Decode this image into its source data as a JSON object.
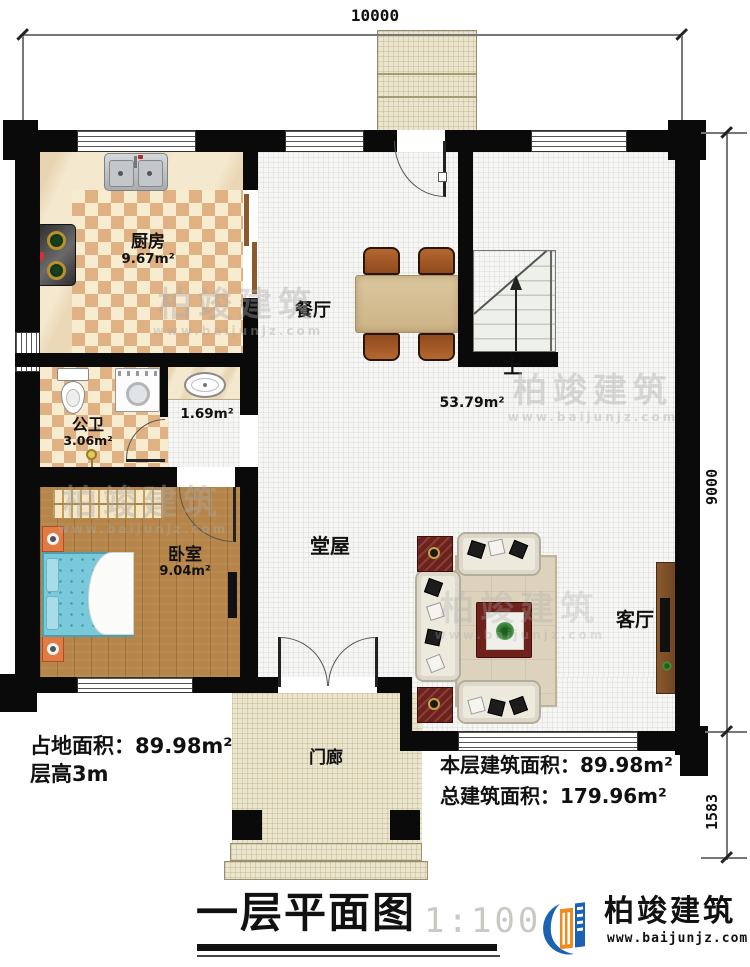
{
  "dimensions": {
    "top": "10000",
    "right_main": "9000",
    "right_lower": "1583"
  },
  "rooms": {
    "kitchen": {
      "name": "厨房",
      "area": "9.67m²"
    },
    "bathroom": {
      "name": "公卫",
      "area": "3.06m²"
    },
    "washroom": {
      "area": "1.69m²"
    },
    "bedroom": {
      "name": "卧室",
      "area": "9.04m²"
    },
    "dining": {
      "name": "餐厅"
    },
    "hall": {
      "name": "堂屋",
      "area": "53.79m²"
    },
    "living": {
      "name": "客厅"
    },
    "porch": {
      "name": "门廊"
    },
    "stairs": {
      "up_label": "上"
    }
  },
  "annotations": {
    "land_area": "占地面积：89.98m²",
    "floor_height": "层高3m",
    "floor_area": "本层建筑面积：89.98m²",
    "total_area": "总建筑面积：179.96m²"
  },
  "title_block": {
    "title": "一层平面图",
    "scale": "1:100"
  },
  "brand": {
    "name": "柏竣建筑",
    "website": "www.baijunjz.com"
  },
  "watermark": {
    "name": "柏竣建筑",
    "website": "www.baijunjz.com"
  },
  "colors": {
    "wall": "#0a0a0a",
    "checker_dark": "#dfb183",
    "checker_light": "#f7ecd0",
    "hall_tile": "#f6f6f4",
    "porch_tile": "#ebe5cd",
    "wood_floor": "#b5854a",
    "bed_blue": "#79c9da",
    "furniture_red": "#6e221b",
    "logo_blue": "#1b62b5",
    "logo_orange": "#f08a1d"
  }
}
